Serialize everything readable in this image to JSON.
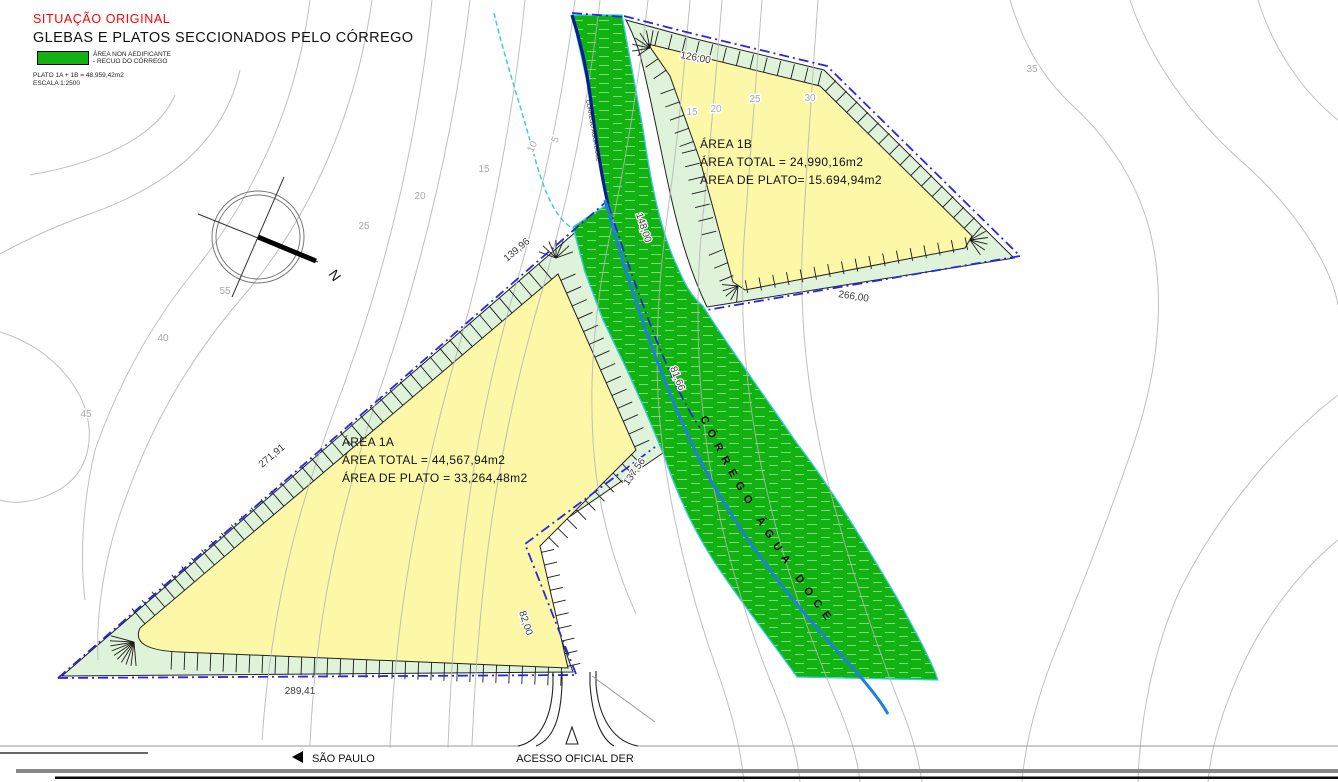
{
  "header": {
    "title": "SITUAÇÃO ORIGINAL",
    "subtitle": "GLEBAS E PLATOS SECCIONADOS PELO CÓRREGO",
    "legend_line1": "ÁREA NON AEDIFICANTE",
    "legend_line2": "- RECUO DO CÓRREGO",
    "note_plato": "PLATO 1A + 1B = 48,959,42m2",
    "note_escala": "ESCALA 1:2500"
  },
  "areas": {
    "a1a": {
      "name": "ÁREA 1A",
      "total": "ÁREA TOTAL = 44,567,94m2",
      "plato": "ÁREA DE PLATO = 33,264,48m2"
    },
    "a1b": {
      "name": "ÁREA 1B",
      "total": "ÁREA TOTAL = 24,990,16m2",
      "plato": "ÁREA DE PLATO= 15.694,94m2"
    }
  },
  "stream": {
    "name": "CÓRREGO ÁGUA DOCE"
  },
  "compass": {
    "north": "N"
  },
  "roads": {
    "west": "SÃO PAULO",
    "access": "ACESSO OFICIAL DER"
  },
  "dimensions": {
    "d139": "139,96",
    "d271": "271,91",
    "d289": "289,41",
    "d82": "82,00",
    "d137": "137,56",
    "d148": "148,00",
    "d81": "81,66",
    "d126": "126,00",
    "d266": "266,00"
  },
  "contours": {
    "c5": "5",
    "c10": "10",
    "c15": "15",
    "c20": "20",
    "c25": "25",
    "c15b": "15",
    "c20b": "20",
    "c25b": "25",
    "c30": "30",
    "c35": "35",
    "c40": "40",
    "c45": "45",
    "c55": "55"
  },
  "colors": {
    "plateau": "#FCF8A8",
    "recuo_strip": "#DFF3DA",
    "corridor": "#12B212",
    "corridor_hatch": "#77DD77",
    "stream": "#1F7FDD",
    "boundary": "#2727E0",
    "navy_edge": "#001E96",
    "cyan_edge": "#38CCE6",
    "contour": "#B5B5B5",
    "title_red": "#FF0000"
  }
}
